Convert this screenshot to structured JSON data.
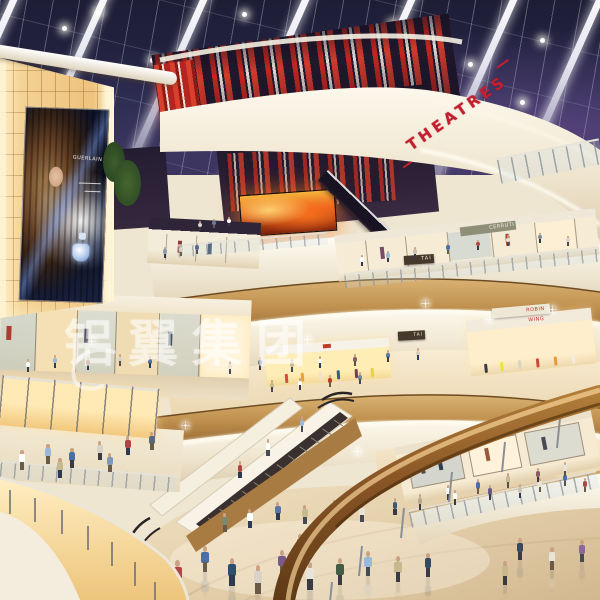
{
  "scene_title": "Shopping mall atrium interior rendering",
  "watermark": {
    "text": "铝翼集团"
  },
  "signs": {
    "theatres": "THEATRES",
    "tai_tai": "TAI TAI",
    "cerruti": "CERRUTI 1881",
    "red_store": "ROBIN WING",
    "billboard_brand": "GUERLAIN"
  },
  "colors": {
    "theatres_red": "#c41f2e",
    "stripe_red": "#c2271f",
    "night_sky": "#23233f",
    "amber_wall": "#f4d294",
    "fascia_cream": "#f3ead7",
    "wood_balustrade": "#b5854a",
    "floor_marble": "#e3d2b4",
    "handrail_wood": "#8a5626",
    "screen_fire": "#e85c1a"
  }
}
